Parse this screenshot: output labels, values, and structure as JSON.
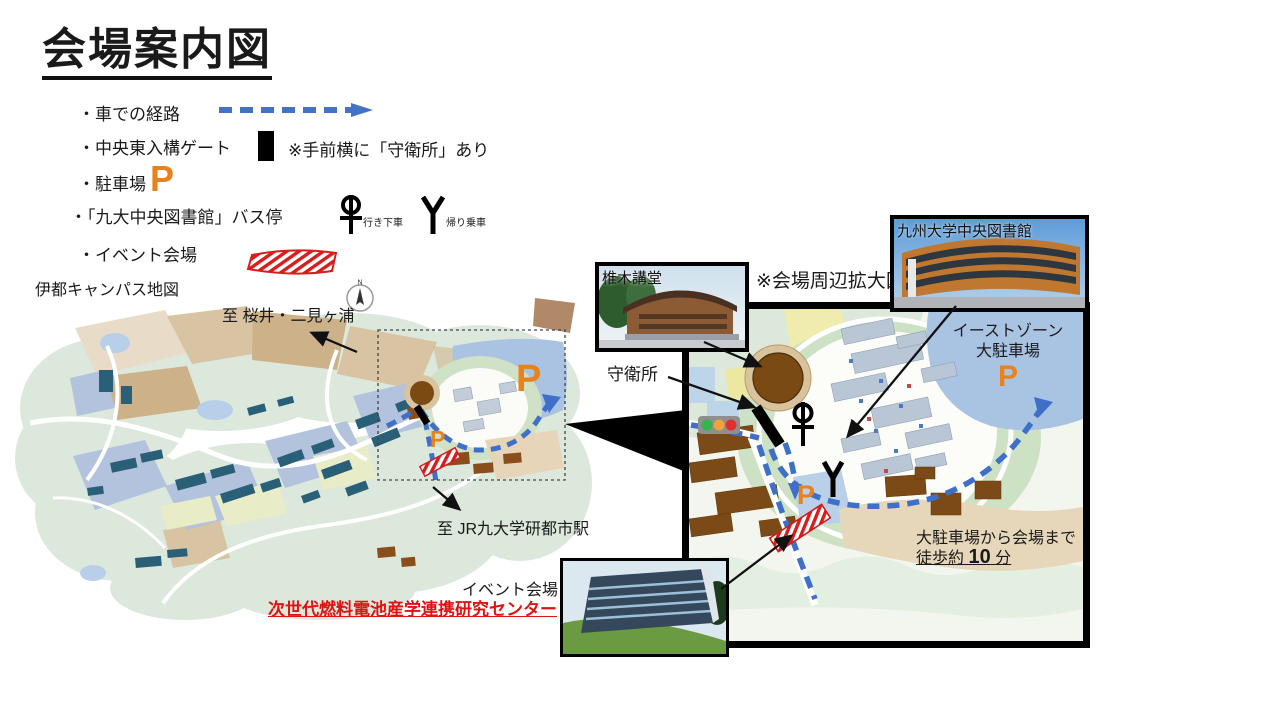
{
  "slide": {
    "title": "会場案内図"
  },
  "legend": {
    "car_route": "・車での経路",
    "gate": "・中央東入構ゲート",
    "gate_note": "※手前横に「守衛所」あり",
    "parking": "・駐車場",
    "bus_stop": "・「九大中央図書館」バス停",
    "bus_outbound": "行き下車",
    "bus_return": "帰り乗車",
    "venue": "・イベント会場"
  },
  "symbols": {
    "parking_letter": "P",
    "compass_north": "N"
  },
  "left_map": {
    "caption": "伊都キャンパス地図",
    "to_sakurai": "至 桜井・二見ヶ浦",
    "to_station": "至 JR九大学研都市駅"
  },
  "right_map": {
    "caption": "※会場周辺拡大図",
    "guard_house": "守衛所",
    "east_zone_line1": "イーストゾーン",
    "east_zone_line2": "大駐車場",
    "walk_line1": "大駐車場から会場まで",
    "walk_prefix": "徒歩約",
    "walk_minutes": "10",
    "walk_suffix": "分"
  },
  "photos": {
    "shiiki_hall": "椎木講堂",
    "central_library": "九州大学中央図書館",
    "venue_label": "イベント会場",
    "venue_name": "次世代燃料電池産学連携研究センター"
  },
  "colors": {
    "route_blue": "#3e6fc9",
    "parking_orange": "#e8821e",
    "venue_red": "#e01212",
    "map_green": "#dde8dc",
    "map_tan": "#d8c3a3",
    "map_water": "#aac3e2"
  }
}
